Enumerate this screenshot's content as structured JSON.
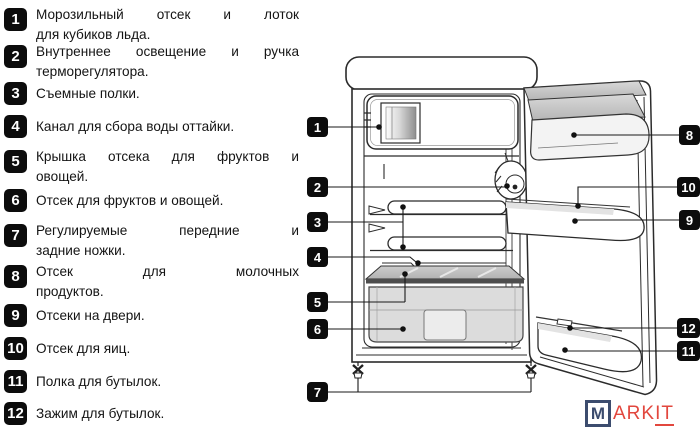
{
  "legend": {
    "items": [
      {
        "num": "1",
        "lines": [
          "Морозильный отсек и лоток",
          "для кубиков льда."
        ]
      },
      {
        "num": "2",
        "lines": [
          "Внутреннее освещение и ручка",
          "терморегулятора."
        ]
      },
      {
        "num": "3",
        "lines": [
          "Съемные полки."
        ]
      },
      {
        "num": "4",
        "lines": [
          "Канал для сбора воды оттайки."
        ]
      },
      {
        "num": "5",
        "lines": [
          "Крышка отсека для фруктов и",
          "овощей."
        ]
      },
      {
        "num": "6",
        "lines": [
          "Отсек для фруктов и овощей."
        ]
      },
      {
        "num": "7",
        "lines": [
          "Регулируемые передние и",
          "задние ножки."
        ]
      },
      {
        "num": "8",
        "lines": [
          "Отсек для молочных",
          "продуктов."
        ]
      },
      {
        "num": "9",
        "lines": [
          "Отсеки на двери."
        ]
      },
      {
        "num": "10",
        "lines": [
          "Отсек для яиц."
        ]
      },
      {
        "num": "11",
        "lines": [
          "Полка для бутылок."
        ]
      },
      {
        "num": "12",
        "lines": [
          "Зажим для бутылок."
        ]
      }
    ]
  },
  "diagram": {
    "callouts": [
      "1",
      "2",
      "3",
      "4",
      "5",
      "6",
      "7",
      "8",
      "9",
      "10",
      "11",
      "12"
    ]
  },
  "watermark": {
    "m": "M",
    "ark": "ARK",
    "it": "IT",
    "box_color": "#3c4c6e",
    "text_color": "#e2473e"
  },
  "colors": {
    "badge_bg": "#0c0c0c",
    "line_art": "#2b2b2b",
    "shade_gray": "#c6c6c6",
    "drawer_gray": "#dcdcdc"
  }
}
